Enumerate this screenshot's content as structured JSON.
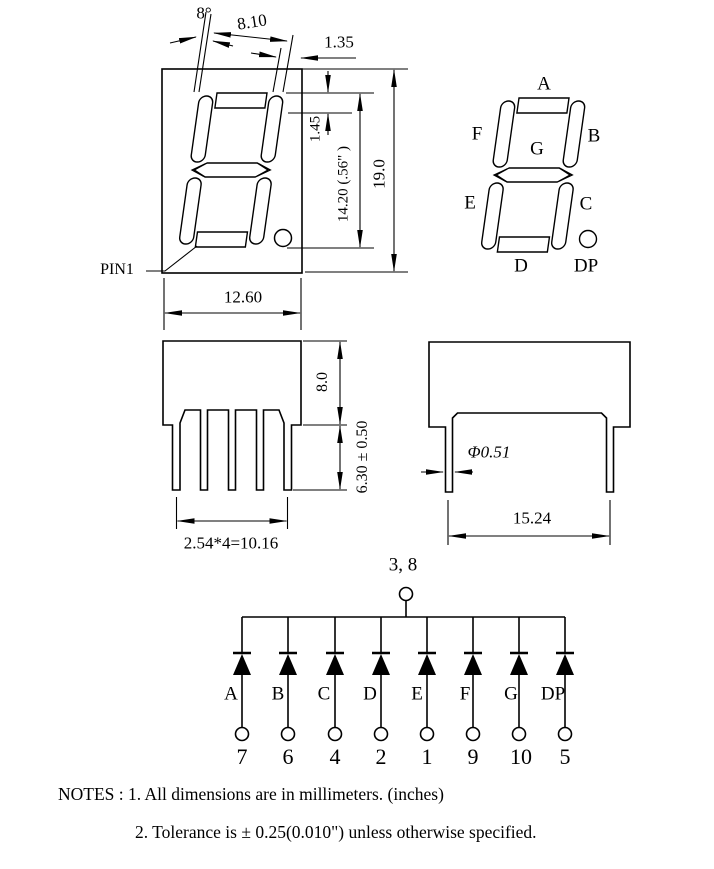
{
  "front_view": {
    "tilt_angle": "8°",
    "digit_width": "8.10",
    "seg_gap": "1.35",
    "seg_thickness": "1.45",
    "digit_height": "14.20 (.56\" )",
    "package_height": "19.0",
    "package_width": "12.60",
    "pin1_label": "PIN1"
  },
  "segment_view": {
    "labels": [
      "A",
      "B",
      "C",
      "D",
      "E",
      "F",
      "G",
      "DP"
    ]
  },
  "side_view_front": {
    "body_depth": "8.0",
    "pin_length": "6.30 ± 0.50",
    "pin_pitch": "2.54*4=10.16"
  },
  "side_view_lateral": {
    "pin_diameter": "Φ0.51",
    "row_spacing": "15.24"
  },
  "circuit": {
    "common_label": "3, 8",
    "segments": [
      "A",
      "B",
      "C",
      "D",
      "E",
      "F",
      "G",
      "DP"
    ],
    "pins": [
      "7",
      "6",
      "4",
      "2",
      "1",
      "9",
      "10",
      "5"
    ]
  },
  "notes": {
    "line1": "NOTES : 1. All dimensions are in millimeters. (inches)",
    "line2": "2. Tolerance is ±  0.25(0.010\") unless otherwise specified."
  },
  "colors": {
    "line": "#000000",
    "background": "#ffffff"
  }
}
